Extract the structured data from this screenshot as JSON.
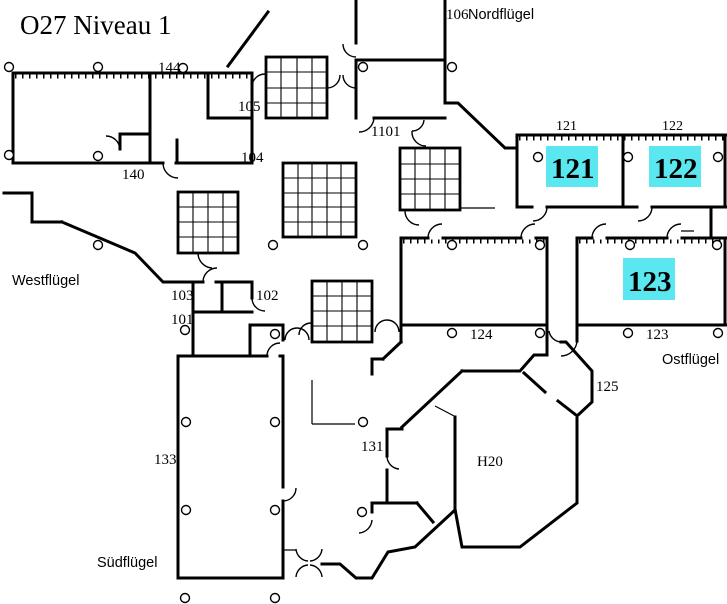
{
  "title": "O27  Niveau 1",
  "colors": {
    "highlight": "#5BE7F0",
    "wall": "#000000",
    "background": "#FFFFFF"
  },
  "wings": {
    "north": "Nordflügel",
    "west": "Westflügel",
    "east": "Ostflügel",
    "south": "Südflügel"
  },
  "highlighted_rooms": {
    "r121": "121",
    "r122": "122",
    "r123": "123"
  },
  "room_labels": {
    "r101": "101",
    "r102": "102",
    "r103": "103",
    "r104": "104",
    "r105": "105",
    "r106": "106",
    "r121": "121",
    "r122": "122",
    "r123": "123",
    "r124": "124",
    "r125": "125",
    "r131": "131",
    "r133": "133",
    "r140": "140",
    "r144": "144",
    "r1101": "1101",
    "h20": "H20"
  }
}
